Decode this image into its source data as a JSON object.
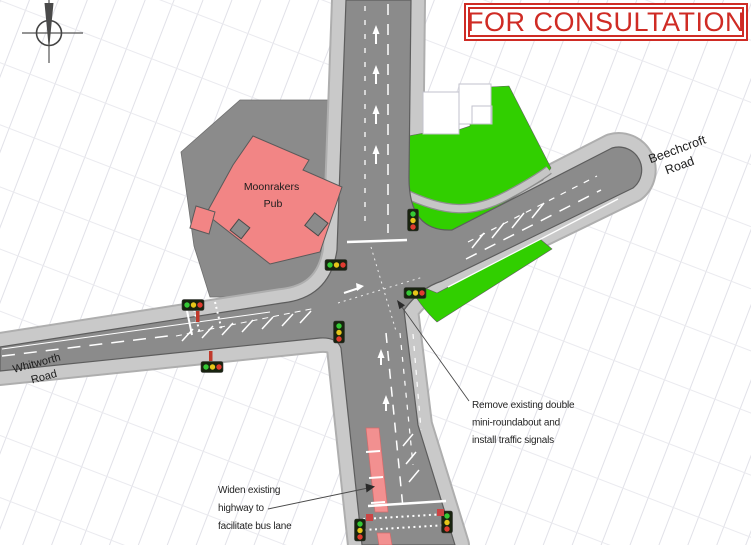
{
  "banner": {
    "text": "FOR CONSULTATION"
  },
  "map": {
    "labels": {
      "pub_line1": "Moonrakers",
      "pub_line2": "Pub",
      "whitworth_line1": "Whitworth",
      "whitworth_line2": "Road",
      "beechcroft_line1": "Beechcroft",
      "beechcroft_line2": "Road"
    },
    "annotations": {
      "remove_line1": "Remove existing double",
      "remove_line2": "mini-roundabout and",
      "remove_line3": "install traffic signals",
      "widen_line1": "Widen existing",
      "widen_line2": "highway to",
      "widen_line3": "facilitate bus lane"
    }
  },
  "colors": {
    "banner_red": "#cf2b24",
    "carriageway_grey": "#8b8b8b",
    "footway_grey": "#c9c9c9",
    "pub_pink": "#f28585",
    "grass_green": "#31cf00",
    "bus_lane_red": "#f29090",
    "marking_white": "#ffffff",
    "signal_green": "#35c935",
    "signal_amber": "#e6c619",
    "signal_red": "#e03c30",
    "background_line_grey": "#dcdce4",
    "text_black": "#1c1c1c"
  }
}
